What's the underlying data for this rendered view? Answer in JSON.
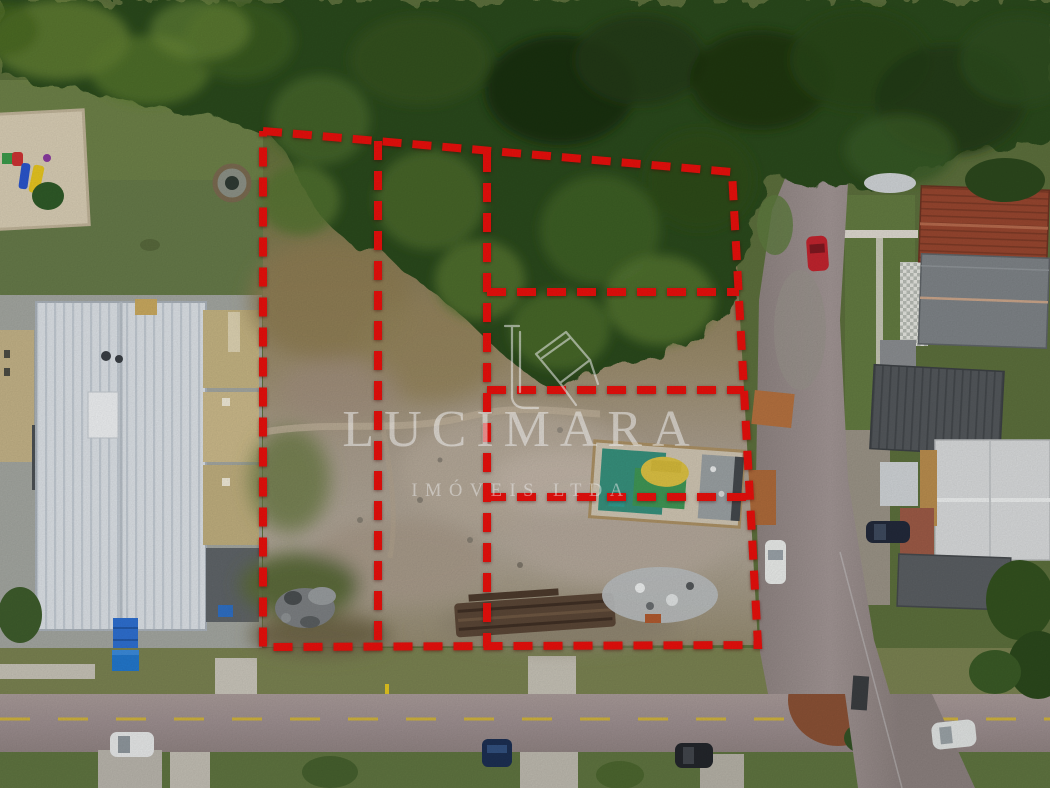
{
  "photo": {
    "kind": "aerial-drone-photograph",
    "subject": "Vacant land divided into lots marked by a red dashed boundary overlay, between a school building (left) and a residential street (right), forest at top, road at bottom"
  },
  "watermark": {
    "brand": "LUCIMARA",
    "subtitle": "IMÓVEIS LTDA",
    "color": "#ffffff",
    "logo": "house-monogram-line-art"
  },
  "boundary_overlay": {
    "color": "#e8100c",
    "stroke_width": 8,
    "dash_pattern": "19 11",
    "outer_points": "263,131 732,172 758,645 263,647 263,131",
    "divider_vertical_1": "378,141 378,647",
    "divider_vertical_2": "487,153 487,647",
    "divider_horizontal_1": "487,292 739,292",
    "divider_horizontal_2": "487,390 744,390",
    "divider_horizontal_3": "487,497 750,497",
    "columns": 3,
    "right_column_rows": 4
  },
  "scene": {
    "vehicles": [
      {
        "name": "red-car-right-road",
        "color": "#c1242e"
      },
      {
        "name": "white-car-right-road",
        "color": "#e9ebe9"
      },
      {
        "name": "dark-car-driveway",
        "color": "#22293a"
      },
      {
        "name": "white-car-bottom-left",
        "color": "#e6e8e8"
      },
      {
        "name": "blue-car-bottom",
        "color": "#1c2f52"
      },
      {
        "name": "dark-car-bottom",
        "color": "#23262b"
      },
      {
        "name": "white-car-bottom-right",
        "color": "#e0e3e2"
      }
    ],
    "features": [
      "dense-forest-top",
      "playground-top-left",
      "school-white-ribbed-roof",
      "blue-entrance-canopy",
      "vacant-lot-dry-brush",
      "debris-piles",
      "lumber-stack",
      "ruined-structure-teal-tarps-yellow-machine",
      "vertical-side-road",
      "red-tile-roof-house",
      "gray-roof-houses",
      "bottom-road-yellow-centerline"
    ],
    "palette": {
      "forest_dark": "#1f3a17",
      "forest_mid": "#2f5220",
      "forest_light": "#5d7c2f",
      "scrub_tan": "#91815c",
      "dirt_light": "#aea293",
      "lawn": "#647c40",
      "road": "#9d8f90",
      "roof_white": "#dce1e5",
      "roof_red": "#96462f",
      "roof_gray": "#7e8387",
      "roof_dark": "#4e5357",
      "teal_tarp": "#37907c",
      "machine_yellow": "#dcc143",
      "sand": "#d8cdb4",
      "canopy_blue": "#2e6fd0",
      "centerline_yellow": "#d8b92f"
    }
  }
}
